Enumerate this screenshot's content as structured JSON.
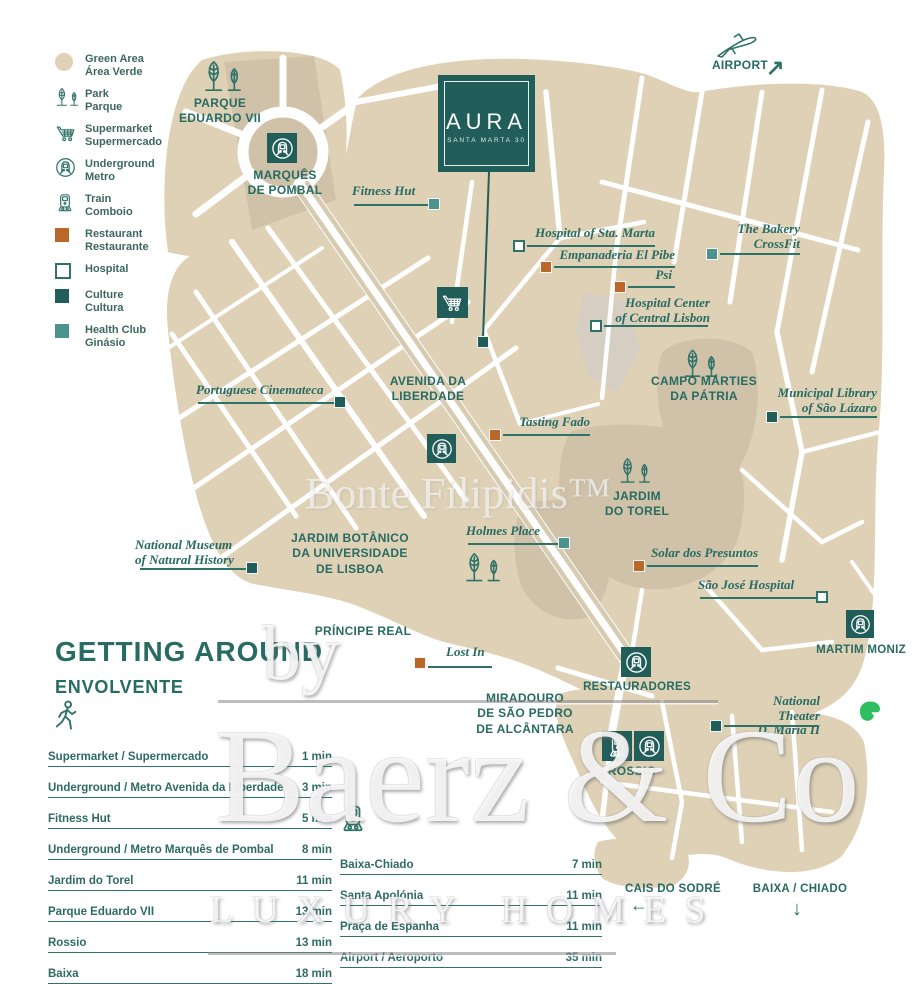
{
  "colors": {
    "teal_dark": "#215E59",
    "teal_text": "#276B62",
    "health_club": "#4D938D",
    "restaurant": "#B9672A",
    "map_beige": "#DED1B6",
    "park_beige": "#CFC2A9",
    "evernote_green": "#2DBE60"
  },
  "legend": {
    "items": [
      {
        "icon": "green-area-swatch",
        "line1": "Green Area",
        "line2": "Área Verde"
      },
      {
        "icon": "park-trees-icon",
        "line1": "Park",
        "line2": "Parque"
      },
      {
        "icon": "supermarket-cart-icon",
        "line1": "Supermarket",
        "line2": "Supermercado"
      },
      {
        "icon": "underground-metro-icon",
        "line1": "Underground",
        "line2": "Metro"
      },
      {
        "icon": "train-icon",
        "line1": "Train",
        "line2": "Comboio"
      },
      {
        "icon": "restaurant-swatch",
        "line1": "Restaurant",
        "line2": "Restaurante"
      },
      {
        "icon": "hospital-swatch",
        "line1": "Hospital",
        "line2": ""
      },
      {
        "icon": "culture-swatch",
        "line1": "Culture",
        "line2": "Cultura"
      },
      {
        "icon": "health-club-swatch",
        "line1": "Health Club",
        "line2": "Ginásio"
      }
    ]
  },
  "property": {
    "name": "AURA",
    "address": "SANTA MARTA 30"
  },
  "areas": {
    "airport": "AIRPORT",
    "parque_eduardo_vii": "PARQUE\nEDUARDO VII",
    "marques_de_pombal": "MARQUÊS\nDE POMBAL",
    "avenida_da_liberdade": "AVENIDA DA\nLIBERDADE",
    "campo_martires": "CAMPO MÁRTIES\nDA PÁTRIA",
    "jardim_do_torel": "JARDIM\nDO TOREL",
    "jardim_botanico": "JARDIM BOTÂNICO\nDA UNIVERSIDADE\nDE LISBOA",
    "principe_real": "PRÍNCIPE REAL",
    "miradouro": "MIRADOURO\nDE SÃO PEDRO\nDE ALCÂNTARA",
    "restauradores": "RESTAURADORES",
    "rossio": "ROSSIO",
    "martim_moniz": "MARTIM MONIZ",
    "cais_do_sodre": "CAIS DO SODRÉ",
    "baixa_chiado": "BAIXA / CHIADO"
  },
  "pois": [
    {
      "label": "Fitness Hut",
      "type": "health_club"
    },
    {
      "label": "Hospital of Sta. Marta",
      "type": "hospital"
    },
    {
      "label": "Empanaderia El Pibe",
      "type": "restaurant"
    },
    {
      "label": "Psi",
      "type": "restaurant"
    },
    {
      "label": "The Bakery\nCrossFit",
      "type": "health_club"
    },
    {
      "label": "Hospital Center\nof Central Lisbon",
      "type": "hospital"
    },
    {
      "label": "Portuguese Cinemateca",
      "type": "culture"
    },
    {
      "label": "Tasting Fado",
      "type": "restaurant"
    },
    {
      "label": "Municipal Library\nof São Lázaro",
      "type": "culture"
    },
    {
      "label": "National Museum\nof Natural History",
      "type": "culture"
    },
    {
      "label": "Holmes Place",
      "type": "health_club"
    },
    {
      "label": "Solar dos Presuntos",
      "type": "restaurant"
    },
    {
      "label": "São José Hospital",
      "type": "hospital"
    },
    {
      "label": "Lost In",
      "type": "restaurant"
    },
    {
      "label": "National Theater\nD. Maria II",
      "type": "culture"
    }
  ],
  "getting_around": {
    "title": "GETTING AROUND",
    "subtitle": "ENVOLVENTE",
    "walk": [
      {
        "label": "Supermarket / Supermercado",
        "time": "1 min"
      },
      {
        "label": "Underground / Metro Avenida da Liberdade",
        "time": "3 min"
      },
      {
        "label": "Fitness Hut",
        "time": "5 min"
      },
      {
        "label": "Underground / Metro Marquês de Pombal",
        "time": "8 min"
      },
      {
        "label": "Jardim do Torel",
        "time": "11 min"
      },
      {
        "label": "Parque Eduardo VII",
        "time": "13 min"
      },
      {
        "label": "Rossio",
        "time": "13 min"
      },
      {
        "label": "Baixa",
        "time": "18 min"
      }
    ],
    "transit": [
      {
        "label": "Baixa-Chiado",
        "time": "7 min"
      },
      {
        "label": "Santa Apolónia",
        "time": "11 min"
      },
      {
        "label": "Praça de Espanha",
        "time": "11 min"
      },
      {
        "label": "Airport / Aeroporto",
        "time": "35 min"
      }
    ]
  },
  "watermarks": {
    "center": "Bonte Filipidis™",
    "by": "by",
    "brand": "Baerz & Co",
    "tagline": "LUXURY HOMES"
  }
}
